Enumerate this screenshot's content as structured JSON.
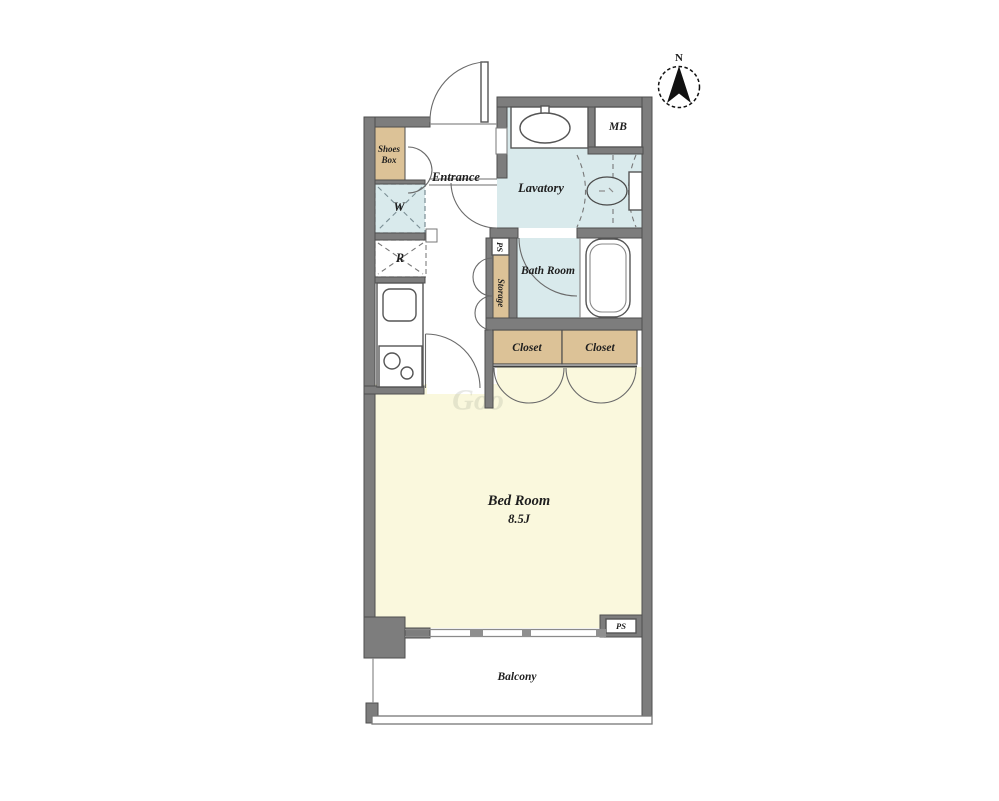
{
  "compass": {
    "north": "N"
  },
  "rooms": {
    "entrance": "Entrance",
    "shoes_box": {
      "line1": "Shoes",
      "line2": "Box"
    },
    "lavatory": "Lavatory",
    "bath_room": "Bath Room",
    "storage": "Storage",
    "closet_left": "Closet",
    "closet_right": "Closet",
    "bed_room": {
      "name": "Bed Room",
      "size": "8.5J"
    },
    "balcony": "Balcony"
  },
  "fixtures": {
    "washing_machine": "W",
    "refrigerator": "R",
    "meter_box": "MB",
    "pipe_space_upper": "PS",
    "pipe_space_lower": "PS"
  },
  "watermark": "Goo",
  "colors": {
    "wall": "#7d7d7d",
    "wall_outline": "#4e4e4e",
    "room_cream": "#faf8dd",
    "wet_area_blue": "#d9eaec",
    "closet_tan": "#dcc297",
    "floor_white": "#ffffff"
  }
}
